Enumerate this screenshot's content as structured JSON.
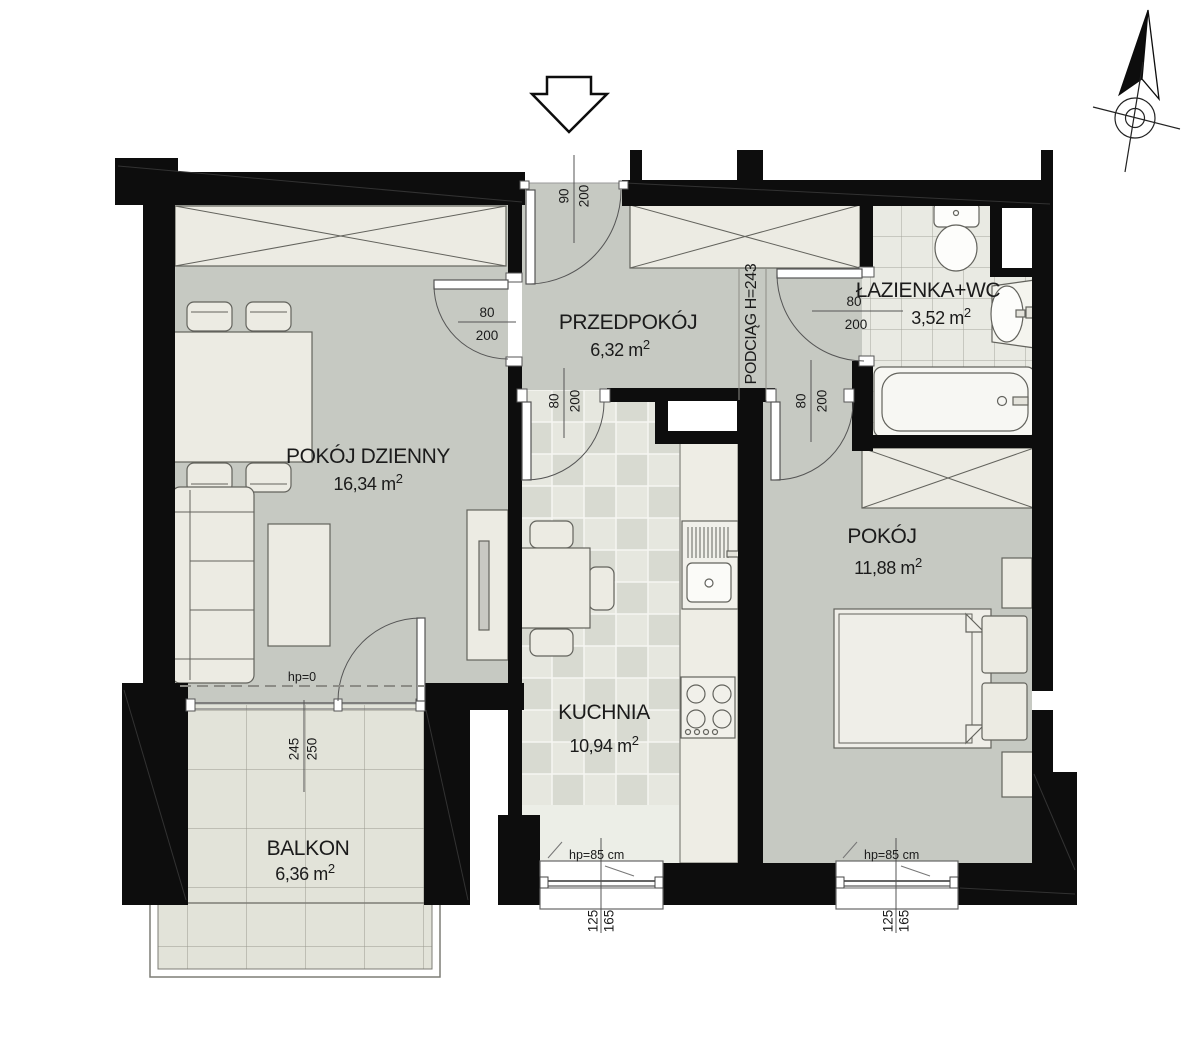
{
  "rooms": {
    "living": {
      "label": "POKÓJ DZIENNY",
      "area": "16,34 m",
      "sup": "2"
    },
    "hall": {
      "label": "PRZEDPOKÓJ",
      "area": "6,32 m",
      "sup": "2"
    },
    "bathroom": {
      "label": "ŁAZIENKA+WC",
      "area": "3,52 m",
      "sup": "2"
    },
    "bedroom": {
      "label": "POKÓJ",
      "area": "11,88 m",
      "sup": "2"
    },
    "kitchen": {
      "label": "KUCHNIA",
      "area": "10,94 m",
      "sup": "2"
    },
    "balcony": {
      "label": "BALKON",
      "area": "6,36 m",
      "sup": "2"
    }
  },
  "doors": {
    "entrance": {
      "width": "90",
      "height": "200"
    },
    "living": {
      "width": "80",
      "height": "200"
    },
    "kitchen": {
      "width": "80",
      "height": "200"
    },
    "bedroom": {
      "width": "80",
      "height": "200"
    },
    "bathroom": {
      "width": "80",
      "height": "200"
    },
    "balcony": {
      "width": "245",
      "height": "250"
    }
  },
  "windows": {
    "kitchen": {
      "hp": "hp=85 cm",
      "width": "125",
      "height": "165"
    },
    "bedroom": {
      "hp": "hp=85 cm",
      "width": "125",
      "height": "165"
    }
  },
  "annotations": {
    "beam": "PODCIĄG H=243",
    "threshold": "hp=0"
  },
  "icons": {
    "compass": "north-arrow-icon",
    "entrance_arrow": "entrance-arrow-icon"
  },
  "colors": {
    "wall": "#0d0d0d",
    "floor_gray": "#c6c9c2",
    "furniture": "#ecebe3",
    "balcony_tile": "#e2e3d9",
    "bath_tile": "#e9eae3",
    "kitchen_tile_a": "#e6e7df",
    "kitchen_tile_b": "#d8dad1"
  }
}
